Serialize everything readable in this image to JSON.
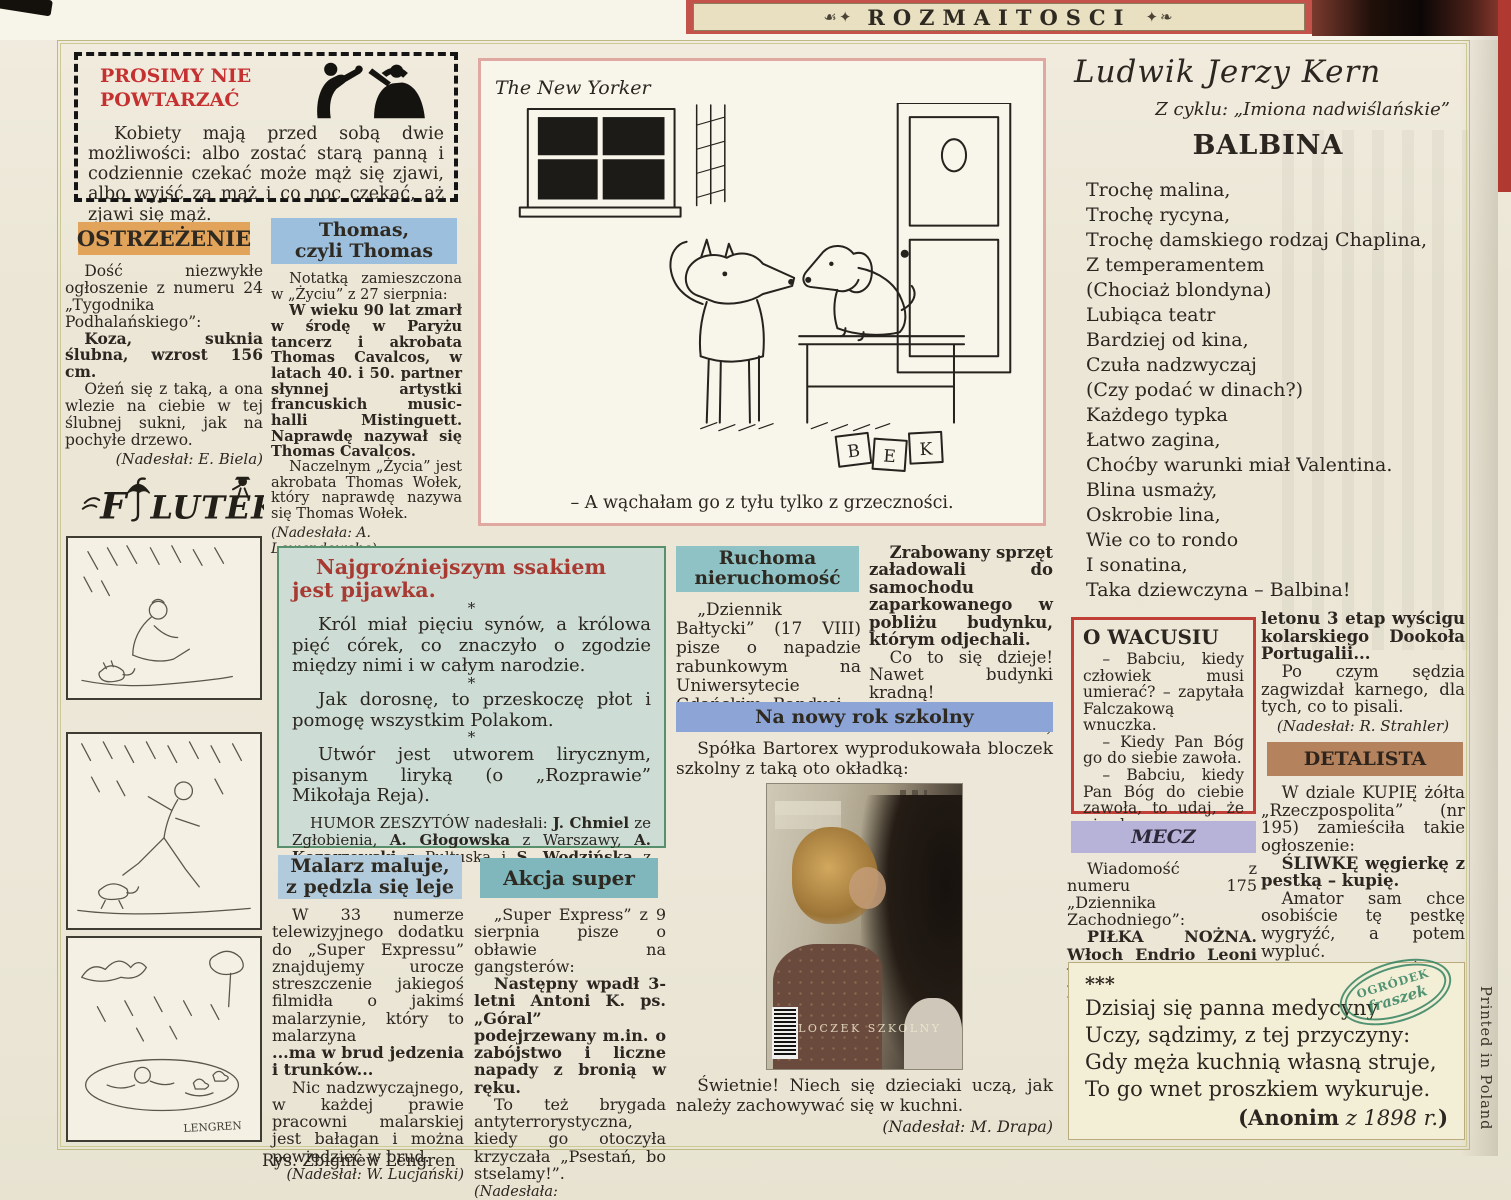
{
  "banner": {
    "title": "ROZMAITOSCI",
    "ornament_left": "☙✦",
    "ornament_right": "✦❧"
  },
  "edge": {
    "printed_in": "Printed in Poland",
    "artist_credit": "Rys. Zbigniew Lengren"
  },
  "colors": {
    "banner_red": "#c2524a",
    "ostrzezenie_bg": "#e2a35b",
    "thomas_bg": "#9dbfde",
    "humor_bg": "#cddcd5",
    "humor_border": "#58906e",
    "humor_title": "#a83a32",
    "ruchoma_bg": "#8fc2c4",
    "szkolny_bg": "#8da5d6",
    "owacusiu_border": "#c04038",
    "mecz_bg": "#b7b2d8",
    "detalista_bg": "#b4835e",
    "malarz_bg": "#b2cbdc",
    "akcja_bg": "#7fb7bd",
    "cartoon_border": "#dfa9a2",
    "stamp_green": "#2e7e5c",
    "prosimy_red": "#c53030"
  },
  "prosimy": {
    "title_line1": "PROSIMY NIE",
    "title_line2": "POWTARZAĆ",
    "body": "Kobiety mają przed sobą dwie możliwości: albo zostać starą panną i codziennie czekać może mąż się zjawi, albo wyjść za mąż i co noc czekać, aż zjawi się mąż."
  },
  "ostrzezenie": {
    "header": "OSTRZEŻENIE",
    "p1": "Dość niezwykłe ogłoszenie z numeru 24 „Tygodnika Podhalańskiego”:",
    "p2": "Koza, suknia ślubna, wzrost 156 cm.",
    "p3": "Ożeń się z taką, a ona wlezie na ciebie w tej ślubnej sukni, jak na pochyłe drzewo.",
    "credit": "(Nadesłał: E. Biela)"
  },
  "filutek": {
    "logo_pre": "F",
    "logo_rest": "LUTEK",
    "signature": "LENGREN"
  },
  "thomas": {
    "header_line1": "Thomas,",
    "header_line2": "czyli Thomas",
    "p1": "Notatką zamieszczona w „Życiu” z 27 sierpnia:",
    "p2": "W wieku 90 lat zmarł w środę w Paryżu tancerz i akrobata Thomas Cavalcos, w latach 40. i 50. partner słynnej artystki francuskich music-halli Mistinguett. Naprawdę nazywał się Thomas Cavalcos.",
    "p3": "Naczelnym „Życia” jest akrobata Thomas Wołek, który naprawdę nazywa się Thomas Wołek.",
    "credit": "(Nadesłała: A. Lewandowska)"
  },
  "cartoon": {
    "source": "The New Yorker",
    "caption": "– A wąchałam go z tyłu tylko z grzeczności.",
    "sig": [
      "B",
      "E",
      "K"
    ]
  },
  "kern": {
    "author": "Ludwik Jerzy Kern",
    "series": "Z cyklu: „Imiona nadwiślańskie”",
    "title": "BALBINA",
    "lines": [
      "Trochę malina,",
      "Trochę rycyna,",
      "Trochę damskiego rodzaj Chaplina,",
      "Z temperamentem",
      "(Chociaż blondyna)",
      "Lubiąca teatr",
      "Bardziej od kina,",
      "Czuła nadzwyczaj",
      "(Czy podać w dinach?)",
      "Każdego typka",
      "Łatwo zagina,",
      "Choćby warunki miał Valentina.",
      "Blina usmaży,",
      "Oskrobie lina,",
      "Wie co to rondo",
      "I sonatina,",
      "Taka dziewczyna – Balbina!"
    ]
  },
  "humor": {
    "title": "Najgroźniejszym ssakiem jest pijawka.",
    "star": "*",
    "p1": "Król miał pięciu synów, a królowa pięć córek, co znaczyło o zgodzie między nimi i w całym narodzie.",
    "p2": "Jak dorosnę, to przeskoczę płot i pomogę wszystkim Polakom.",
    "p3": "Utwór jest utworem lirycznym, pisanym liryką (o „Rozprawie” Mikołaja Reja).",
    "footer": [
      {
        "t": "HUMOR ZESZYTÓW nadesłali: "
      },
      {
        "t": "J. Chmiel",
        "b": 1
      },
      {
        "t": " ze Zgłobienia, "
      },
      {
        "t": "A. Głogowska",
        "b": 1
      },
      {
        "t": " z Warszawy, "
      },
      {
        "t": "A. Kozarzewski",
        "b": 1
      },
      {
        "t": " z Pułtuska i "
      },
      {
        "t": "S. Wodzińska",
        "b": 1
      },
      {
        "t": " z Kalisza. "
      },
      {
        "t": "Dziękujemy.",
        "i": 1
      }
    ]
  },
  "ruchoma": {
    "header_line1": "Ruchoma",
    "header_line2": "nieruchomość",
    "left": "„Dziennik Bałtycki” (17 VIII) pisze o napadzie rabunkowym na Uniwersytecie Gdańskim. Bandyci",
    "right_bold": "Zrabowany sprzęt załadowali do samochodu zaparkowanego w pobliżu budynku, którym odjechali.",
    "right_p2": "Co to się dzieje! Nawet budynki kradną!",
    "credit": "(Nadesłał: M. Banaszkiewicz)"
  },
  "szkolny": {
    "header": "Na nowy rok szkolny",
    "intro": "Spółka Bartorex wyprodukowała bloczek szkolny z taką oto okładką:",
    "photo_overlay": "BLOCZEK SZKOLNY",
    "outro": "Świetnie! Niech się dzieciaki uczą, jak należy zachowywać się w kuchni.",
    "credit": "(Nadesłał: M. Drapa)"
  },
  "owacusiu": {
    "title": "O WACUSIU",
    "p1": "– Babciu, kiedy człowiek musi umierać? – zapytała Falczakową wnuczka.",
    "p2": "– Kiedy Pan Bóg go do siebie zawoła.",
    "p3": "– Babciu, kiedy Pan Bóg do ciebie zawoła, to udaj, że nie słyszysz."
  },
  "peleton": {
    "p1": "letonu 3 etap wyścigu kolarskiego Dookoła Portugalii...",
    "p2": "Po czym sędzia zagwizdał karnego, dla tych, co to pisali.",
    "credit": "(Nadesłał: R. Strahler)"
  },
  "detalista": {
    "header": "DETALISTA",
    "p1": "W dziale KUPIĘ żółta „Rzeczpospolita” (nr 195) zamieściła takie ogłoszenie:",
    "p2": "ŚLIWKĘ węgierkę z pestką – kupię.",
    "p3": "Amator sam chce osobiście tę pestkę wygryźć, a potem wypluć.",
    "credit": "(Nadesłał: J. Świtek)"
  },
  "mecz": {
    "header": "MECZ",
    "p1": "Wiadomość z numeru 175 „Dziennika Zachodniego”:",
    "p2": "PIŁKA NOŻNA. Włoch Endrio Leoni wygrał po finiszu z pe-"
  },
  "malarz": {
    "header_line1": "Malarz maluje,",
    "header_line2": "z pędzla się leje",
    "p1": "W 33 numerze telewizyjnego dodatku do „Super Expressu” znajdujemy urocze streszczenie jakiegoś filmidła o jakimś malarzynie, który to malarzyna",
    "p2": "...ma w brud jedzenia i trunków...",
    "p3": "Nic nadzwyczajnego, w każdej prawie pracowni malarskiej jest bałagan i można powiedzieć w brud.",
    "credit": "(Nadesłał: W. Lucjański)"
  },
  "akcja": {
    "header": "Akcja super",
    "p1": "„Super Express” z 9 sierpnia pisze o obławie na gangsterów:",
    "p2": "Następny wpadł 3-letni Antoni K. ps. „Góral” podejrzewany m.in. o zabójstwo i liczne napady z bronią w ręku.",
    "p3": "To też brygada antyterrorystyczna, kiedy go otoczyła krzyczała „Psestań, bo stselamy!”.",
    "credit": "(Nadesłała: K.Tomaszewska)"
  },
  "anonim": {
    "stars": "***",
    "lines": [
      "Dzisiaj się panna medycyny",
      "Uczy, sądzimy, z tej przyczyny:",
      "Gdy męża kuchnią własną struje,",
      "To go wnet proszkiem wykuruje."
    ],
    "credit": [
      {
        "t": "(Anonim",
        "b": 1
      },
      {
        "t": " z 1898 r.",
        "i": 1
      },
      {
        "t": ")",
        "b": 1
      }
    ],
    "stamp_line1": "OGRÓDEK",
    "stamp_line2": "fraszek"
  }
}
